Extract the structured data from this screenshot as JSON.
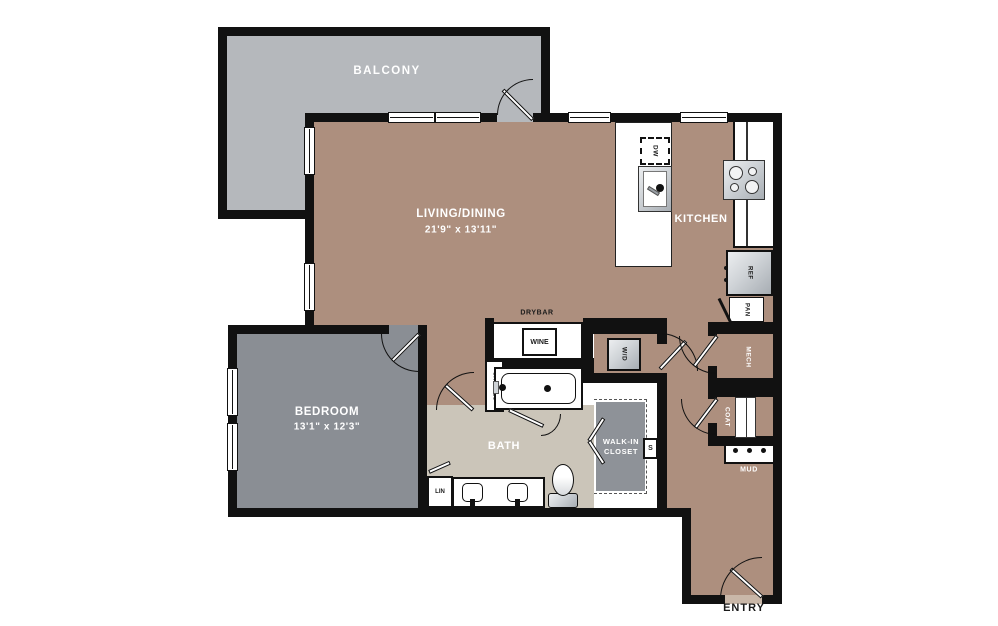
{
  "rooms": {
    "balcony": {
      "label": "BALCONY"
    },
    "living_dining": {
      "label": "LIVING/DINING",
      "dims": "21'9\" x 13'11\""
    },
    "kitchen": {
      "label": "KITCHEN"
    },
    "bedroom": {
      "label": "BEDROOM",
      "dims": "13'1\" x 12'3\""
    },
    "bath": {
      "label": "BATH"
    },
    "walk_in_closet": {
      "line1": "WALK-IN",
      "line2": "CLOSET"
    },
    "mech": {
      "label": "MECH"
    },
    "coat": {
      "label": "COAT"
    },
    "mud": {
      "label": "MUD"
    },
    "entry": {
      "label": "ENTRY"
    }
  },
  "fixtures": {
    "drybar": "DRYBAR",
    "wine": "WINE",
    "shelves": "SHELVES",
    "washer_dryer": "W/D",
    "dishwasher": "DW",
    "refrigerator": "REF",
    "pantry": "PAN",
    "linen": "LIN",
    "shelf": "S"
  },
  "colors": {
    "wall": "#111111",
    "living-floor": "#ad8f7e",
    "balcony-floor": "#b5b8bc",
    "bedroom-floor": "#8a8e94",
    "bath-floor": "#cbc5b9",
    "closet-floor": "#8e9298",
    "threshold": "#c9b7a8"
  }
}
